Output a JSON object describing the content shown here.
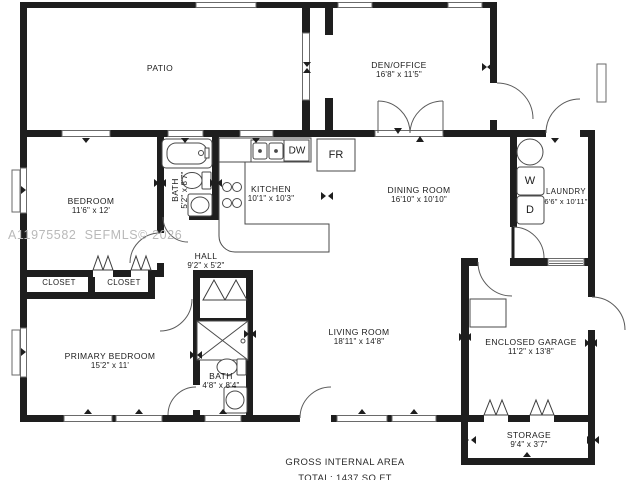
{
  "watermark": "A11975582  SEFMLS© 2026",
  "footer": {
    "line1": "GROSS INTERNAL AREA",
    "line2": "TOTAL: 1437 SQ FT"
  },
  "rooms": {
    "patio": {
      "name": "PATIO",
      "dims": ""
    },
    "den": {
      "name": "DEN/OFFICE",
      "dims": "16'8\" x 11'5\""
    },
    "bedroom": {
      "name": "BEDROOM",
      "dims": "11'6\" x 12'"
    },
    "bath_top": {
      "name": "BATH",
      "dims": "5'2\" x 8'7\""
    },
    "kitchen": {
      "name": "KITCHEN",
      "dims": "10'1\" x 10'3\""
    },
    "dining": {
      "name": "DINING ROOM",
      "dims": "16'10\" x 10'10\""
    },
    "laundry": {
      "name": "LAUNDRY",
      "dims": "6'6\" x 10'11\""
    },
    "hall": {
      "name": "HALL",
      "dims": "9'2\" x 5'2\""
    },
    "closet_left": {
      "name": "CLOSET"
    },
    "closet_right": {
      "name": "CLOSET"
    },
    "primary": {
      "name": "PRIMARY BEDROOM",
      "dims": "15'2\" x 11'"
    },
    "bath_primary": {
      "name": "BATH",
      "dims": "4'8\" x 8'4\""
    },
    "living": {
      "name": "LIVING ROOM",
      "dims": "18'11\" x 14'8\""
    },
    "garage": {
      "name": "ENCLOSED GARAGE",
      "dims": "11'2\" x 13'8\""
    },
    "storage": {
      "name": "STORAGE",
      "dims": "9'4\" x 3'7\""
    }
  },
  "appliances": {
    "dishwasher": "DW",
    "refrigerator": "FR",
    "washer": "W",
    "dryer": "D"
  },
  "colors": {
    "wall": "#1e1e1e",
    "fixture_line": "#4a4a4a",
    "watermark": "#b9b9b9"
  }
}
